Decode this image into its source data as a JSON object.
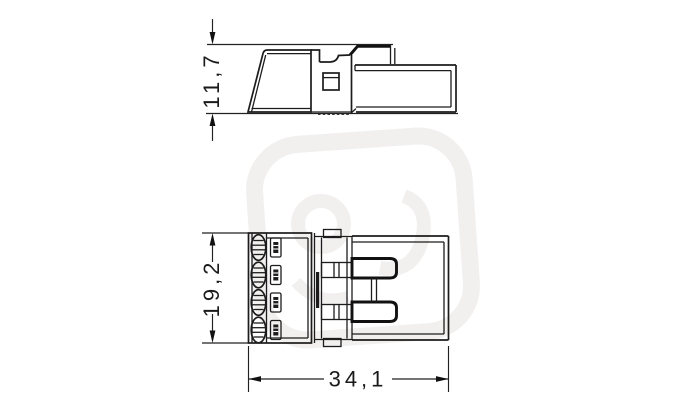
{
  "drawing": {
    "background_color": "#ffffff",
    "line_color": "#1c1c1c",
    "watermark_color": "#f0eded",
    "dimensions": {
      "side_view_height_mm": "11,7",
      "front_view_height_mm": "19,2",
      "front_view_width_mm": "34,1"
    }
  }
}
